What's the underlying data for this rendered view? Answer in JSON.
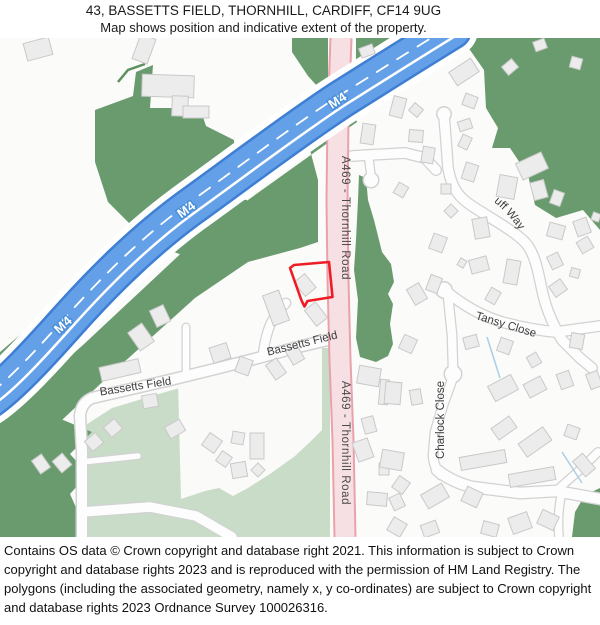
{
  "header": {
    "title": "43, BASSETTS FIELD, THORNHILL, CARDIFF, CF14 9UG",
    "subtitle": "Map shows position and indicative extent of the property."
  },
  "map": {
    "labels": {
      "motorway": "M4",
      "a_road": "A469 - Thornhill Road",
      "bassetts_field": "Bassetts Field",
      "woodruff_way": "Woodruff Way",
      "tansy_close": "Tansy Close",
      "charlock_close": "Charlock Close"
    },
    "colors": {
      "motorway_fill": "#64a0e8",
      "motorway_casing": "#3f7fd3",
      "a_road_fill": "#f7e0e3",
      "a_road_casing": "#e9a2ac",
      "woodland_green": "#6a9b6e",
      "field_green": "#c8dcc8",
      "property_outline": "#ee1c25",
      "building_fill": "#ececec",
      "building_stroke": "#c9c9c9",
      "road_casing": "#d2d2d2",
      "stream_blue": "#a9cfe6",
      "label_gray": "#4a4a4a"
    }
  },
  "footer": {
    "text": "Contains OS data © Crown copyright and database right 2021. This information is subject to Crown copyright and database rights 2023 and is reproduced with the permission of HM Land Registry. The polygons (including the associated geometry, namely x, y co-ordinates) are subject to Crown copyright and database rights 2023 Ordnance Survey 100026316."
  }
}
